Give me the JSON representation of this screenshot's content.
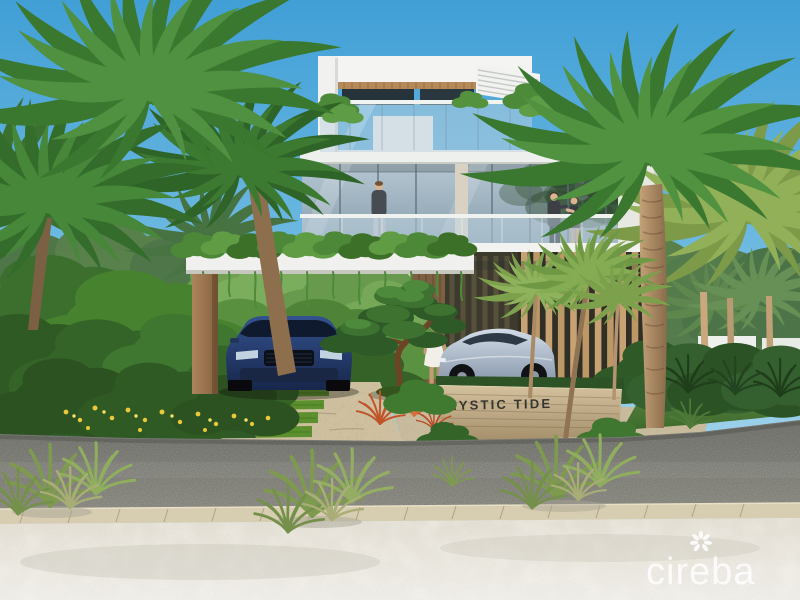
{
  "scene": {
    "kind": "3d-architectural-rendering",
    "subject": "modern three-storey beachfront villa with carport, tropical landscaping, parked cars and beach foreground"
  },
  "sign": {
    "text": "MYSTIC TIDE"
  },
  "watermark": {
    "brand": "cireba",
    "icon": "petal-burst-icon"
  },
  "palette": {
    "sky_top": "#419fd6",
    "sky_horizon": "#cfe8f3",
    "foliage_dark": "#2f5a28",
    "foliage_mid": "#4a8038",
    "foliage_light": "#7fa050",
    "villa_white": "#f0f1ee",
    "timber_accent": "#c8a273",
    "suv_blue": "#2c4a86",
    "coupe_silver": "#b9c6d4",
    "road_asphalt": "#8b8b85",
    "curb_stone": "#d7cdb0",
    "sand": "#ece8df",
    "sign_stone": "#c0ab86",
    "grass_strip": "#5c8f2d"
  }
}
